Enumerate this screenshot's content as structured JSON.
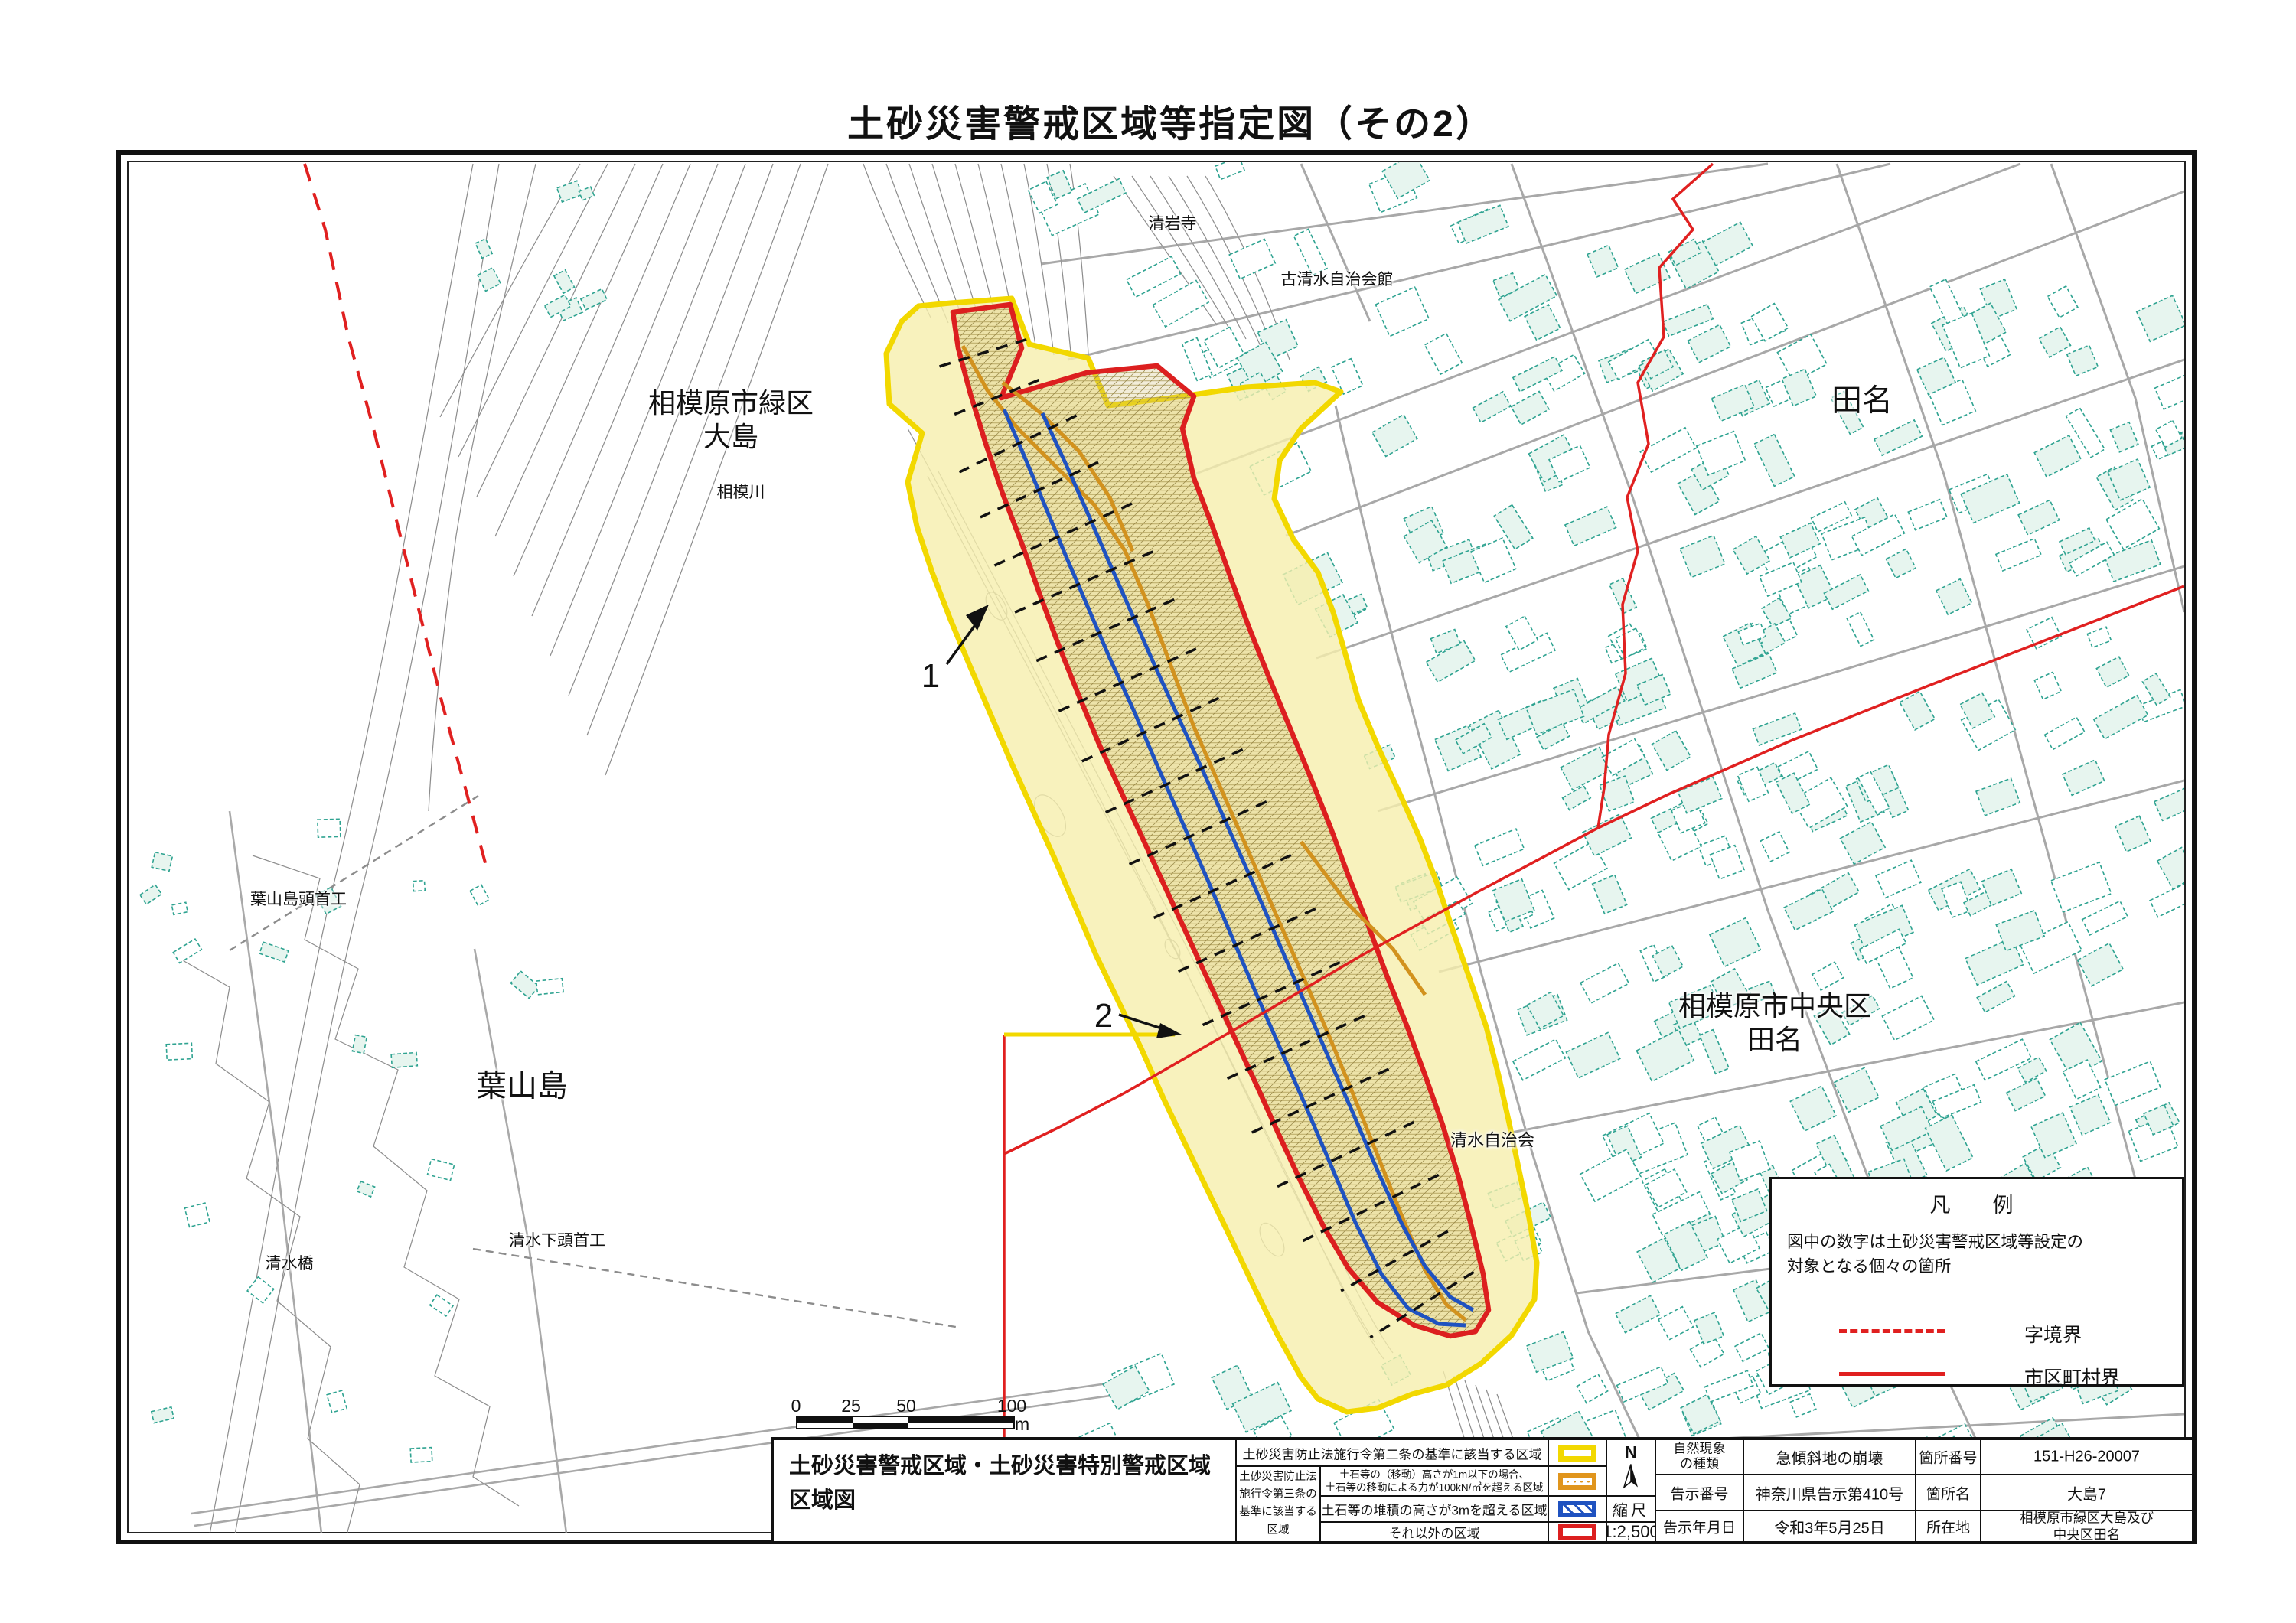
{
  "page": {
    "title": "土砂災害警戒区域等指定図（その2）"
  },
  "map": {
    "place_labels": {
      "midori_ward": {
        "lines": [
          "相模原市緑区",
          "大島"
        ]
      },
      "sagami_river": {
        "lines": [
          "相模川"
        ]
      },
      "tana_north": {
        "lines": [
          "田名"
        ]
      },
      "chuo_ward": {
        "lines": [
          "相模原市中央区",
          "田名"
        ]
      },
      "hayamajima": {
        "lines": [
          "葉山島"
        ]
      },
      "hayamajima_weir": {
        "lines": [
          "葉山島頭首工"
        ]
      },
      "shimizu_lower_weir": {
        "lines": [
          "清水下頭首工"
        ]
      },
      "shimizu_bridge": {
        "lines": [
          "清水橋"
        ]
      },
      "shimizu_assoc": {
        "lines": [
          "清水自治会"
        ]
      },
      "seiganji_temple": {
        "lines": [
          "清岩寺"
        ]
      },
      "koshimizu_hall": {
        "lines": [
          "古清水自治会館"
        ]
      }
    },
    "annotations": [
      {
        "label": "1"
      },
      {
        "label": "2"
      }
    ]
  },
  "legend_box": {
    "title": "凡　例",
    "note_lines": [
      "図中の数字は土砂災害警戒区域等設定の",
      "対象となる個々の箇所"
    ],
    "items": [
      {
        "label": "字境界"
      },
      {
        "label": "市区町村界"
      }
    ]
  },
  "scale_bar": {
    "tick_labels": [
      "0",
      "25",
      "50",
      "100"
    ],
    "unit": "m"
  },
  "legend_table": {
    "map_title_lines": [
      "土砂災害警戒区域・土砂災害特別警戒区域",
      "区域図"
    ],
    "row1_label": "土砂災害防止法施行令第二条の基準に該当する区域",
    "group_label_lines": [
      "土砂災害防止法",
      "施行令第三条の",
      "基準に該当する",
      "区域"
    ],
    "row2_lines": [
      "土石等の（移動）高さが1m以下の場合、",
      "土石等の移動による力が100kN/㎡を超える区域"
    ],
    "row3_label": "土石等の堆積の高さが3mを超える区域",
    "row4_label": "それ以外の区域",
    "north_label": "N",
    "scale_caption": "縮尺",
    "scale_value": "1:2,500"
  },
  "info_table": {
    "rows": [
      {
        "label": "自然現象の種類",
        "label_lines": [
          "自然現象",
          "の種類"
        ],
        "value": "急傾斜地の崩壊",
        "label2": "箇所番号",
        "value2": "151-H26-20007"
      },
      {
        "label": "告示番号",
        "value": "神奈川県告示第410号",
        "label2": "箇所名",
        "value2": "大島7"
      },
      {
        "label": "告示年月日",
        "value": "令和3年5月25日",
        "label2": "所在地",
        "value2_lines": [
          "相模原市緑区大島及び",
          "中央区田名"
        ]
      }
    ]
  },
  "colors": {
    "warning_yellow": "#f2d800",
    "special_red": "#dc1f1f",
    "debris_blue": "#1f52c0",
    "move_orange": "#d2921e",
    "boundary_red": "#e02020",
    "building_teal": "#2fa391"
  }
}
